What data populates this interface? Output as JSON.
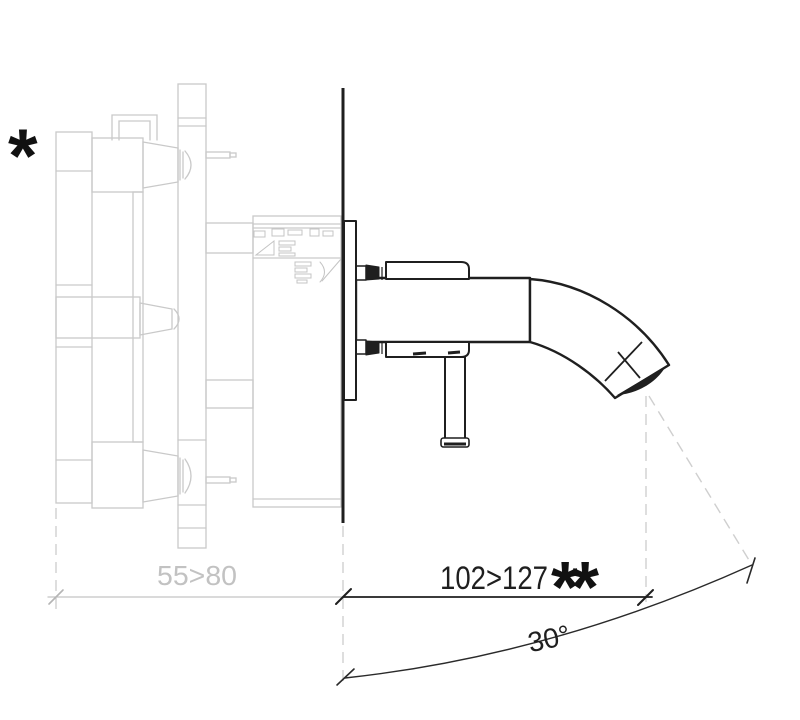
{
  "drawing": {
    "footnote_marker": "*",
    "dim_behind_wall": "55>80",
    "dim_spout": "102>127",
    "dim_spout_note": "**",
    "angle": "30°",
    "colors": {
      "visible_parts": "#1f1f1f",
      "concealed_parts": "#c9c9c9",
      "dim_gray_text": "#c2c2c2",
      "background": "#ffffff"
    }
  }
}
